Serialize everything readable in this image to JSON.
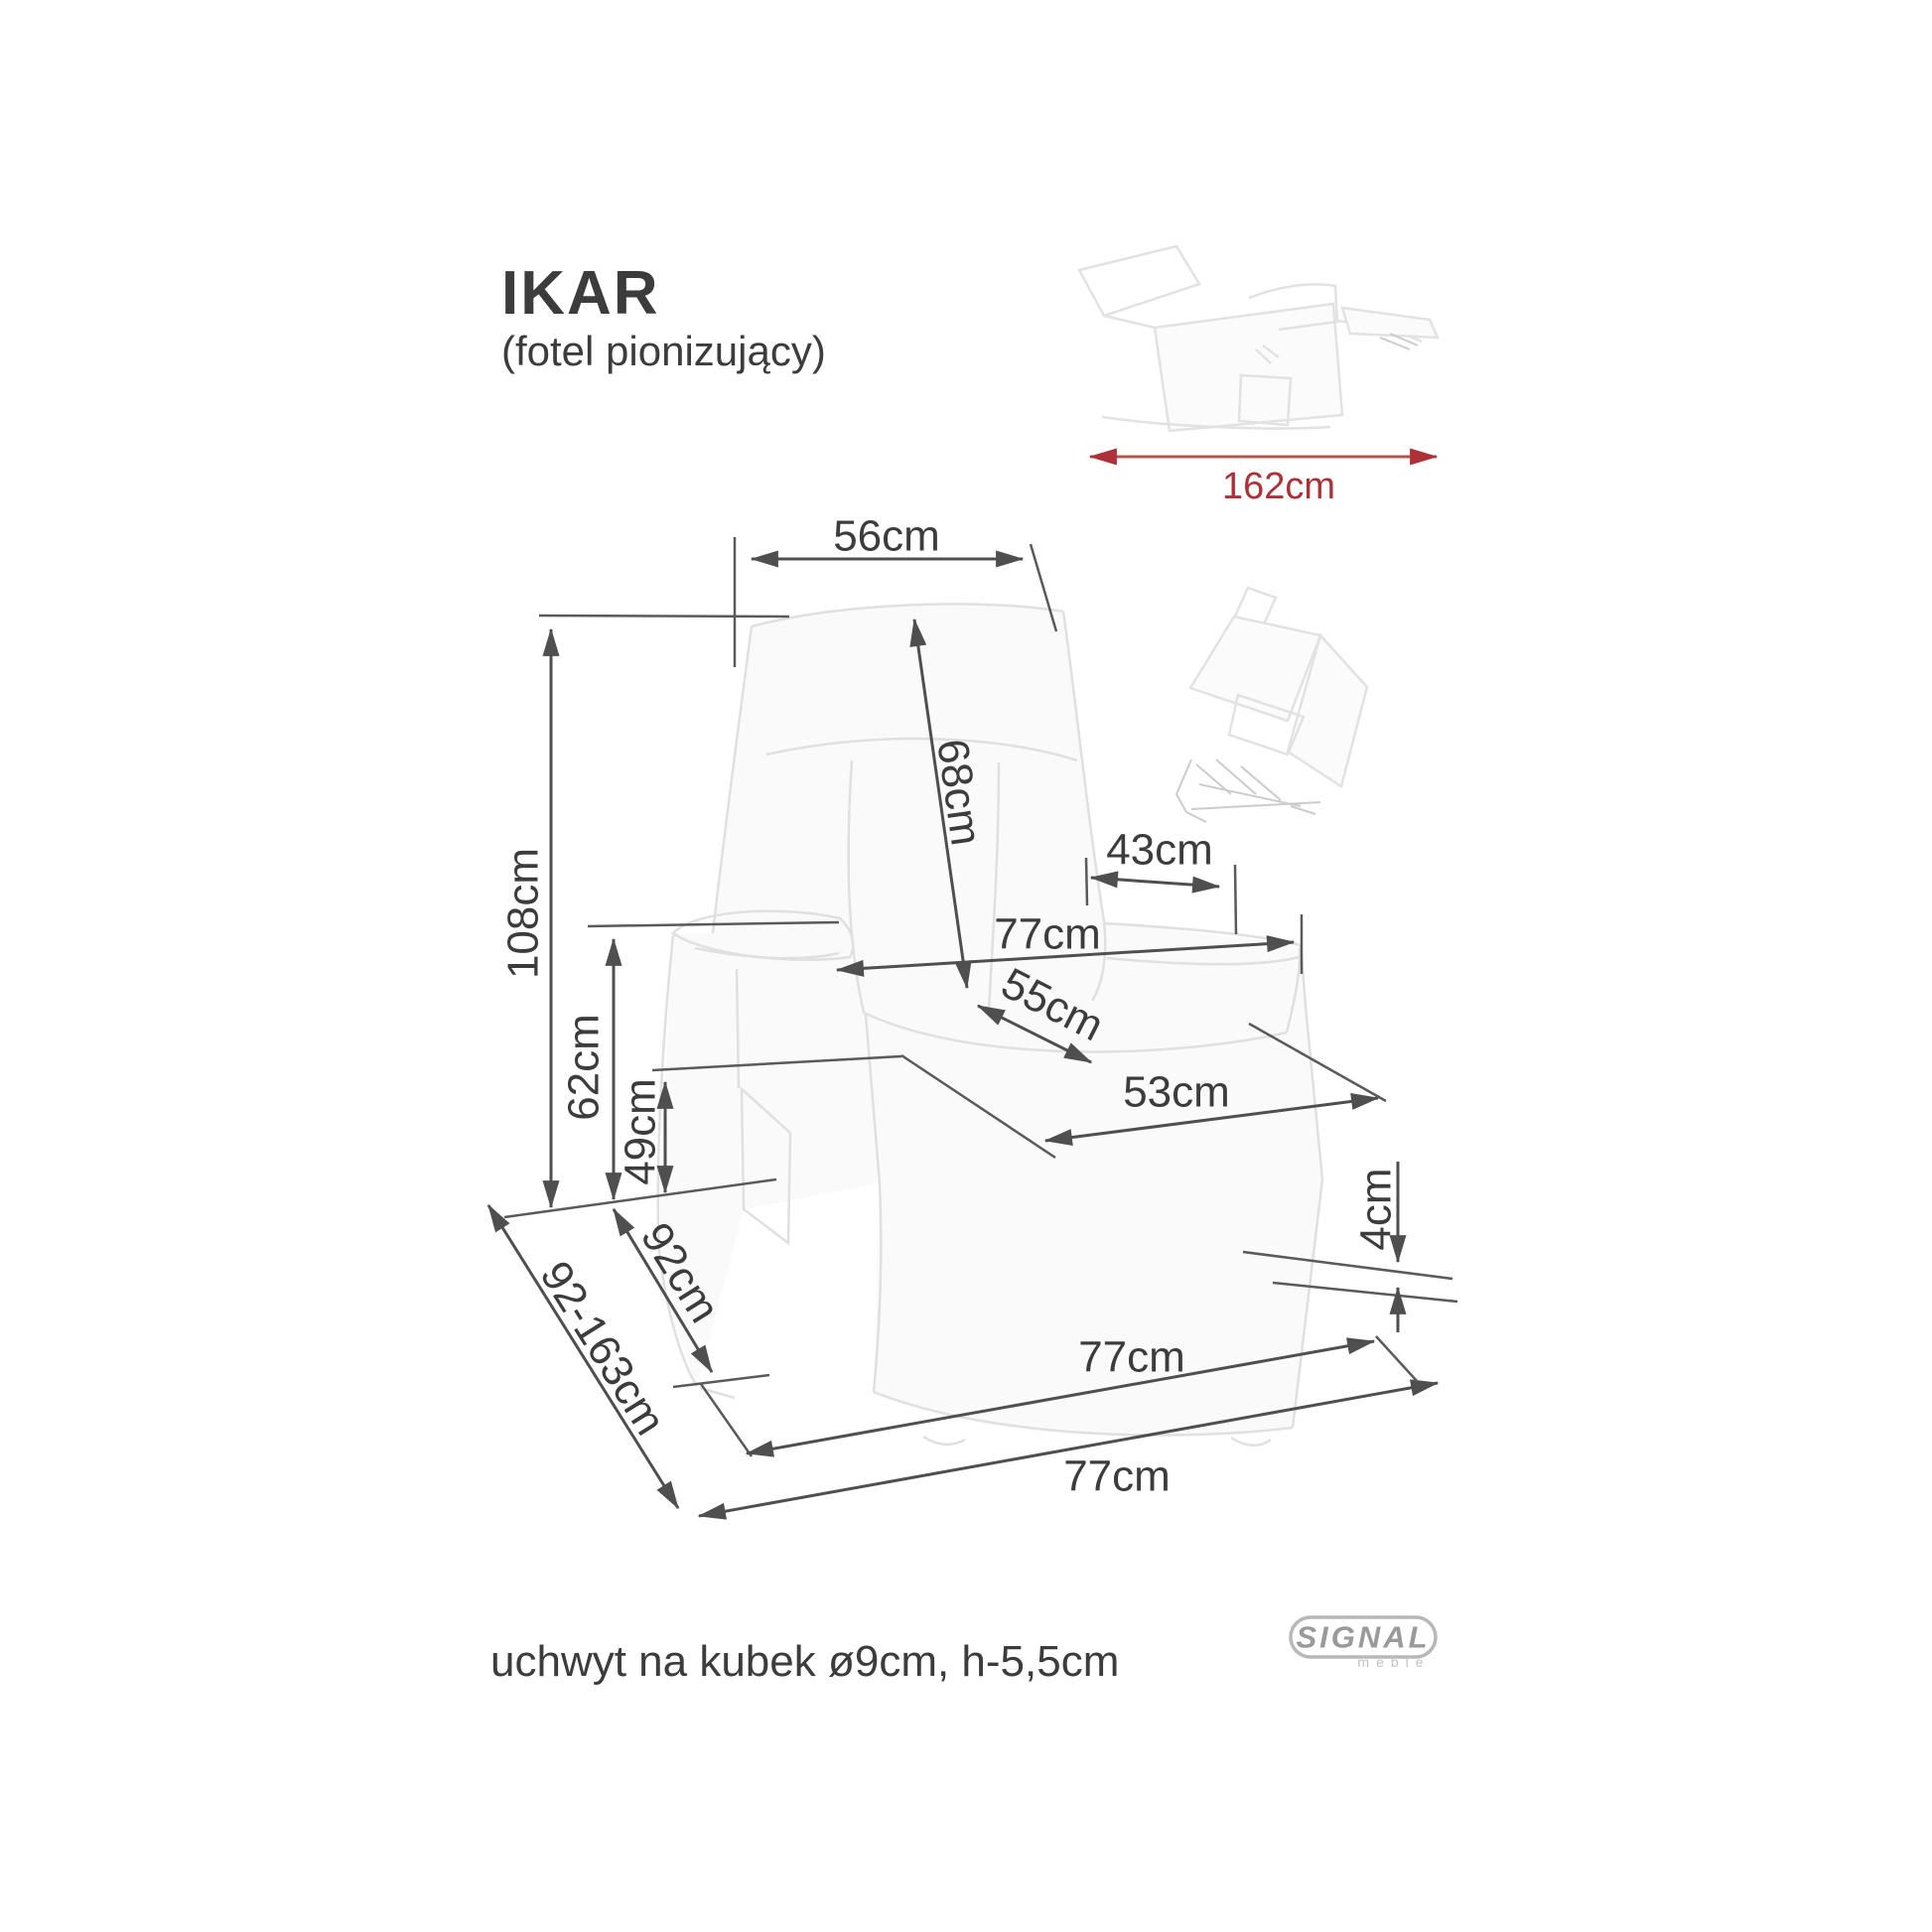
{
  "header": {
    "title": "IKAR",
    "subtitle": "(fotel pionizujący)"
  },
  "overall": {
    "reclined_length": "162cm"
  },
  "dims": {
    "headrest_width": "56cm",
    "backrest_height": "68cm",
    "total_height": "108cm",
    "armrest_length": "43cm",
    "overall_width": "77cm",
    "seat_width": "55cm",
    "seat_depth": "53cm",
    "armrest_height": "62cm",
    "seat_height": "49cm",
    "ground_clearance": "4cm",
    "depth": "92cm",
    "extended_depth": "92-163cm",
    "base_width": "77cm",
    "footprint_width": "77cm"
  },
  "footnote": "uchwyt na kubek ø9cm, h-5,5cm",
  "logo": {
    "brand": "SIGNAL",
    "sub": "meble"
  },
  "colors": {
    "dimension_line": "#4f4f4f",
    "dimension_text": "#3c3c3c",
    "sketch_line": "#e2e2e2",
    "accent_red": "#ad3137"
  }
}
